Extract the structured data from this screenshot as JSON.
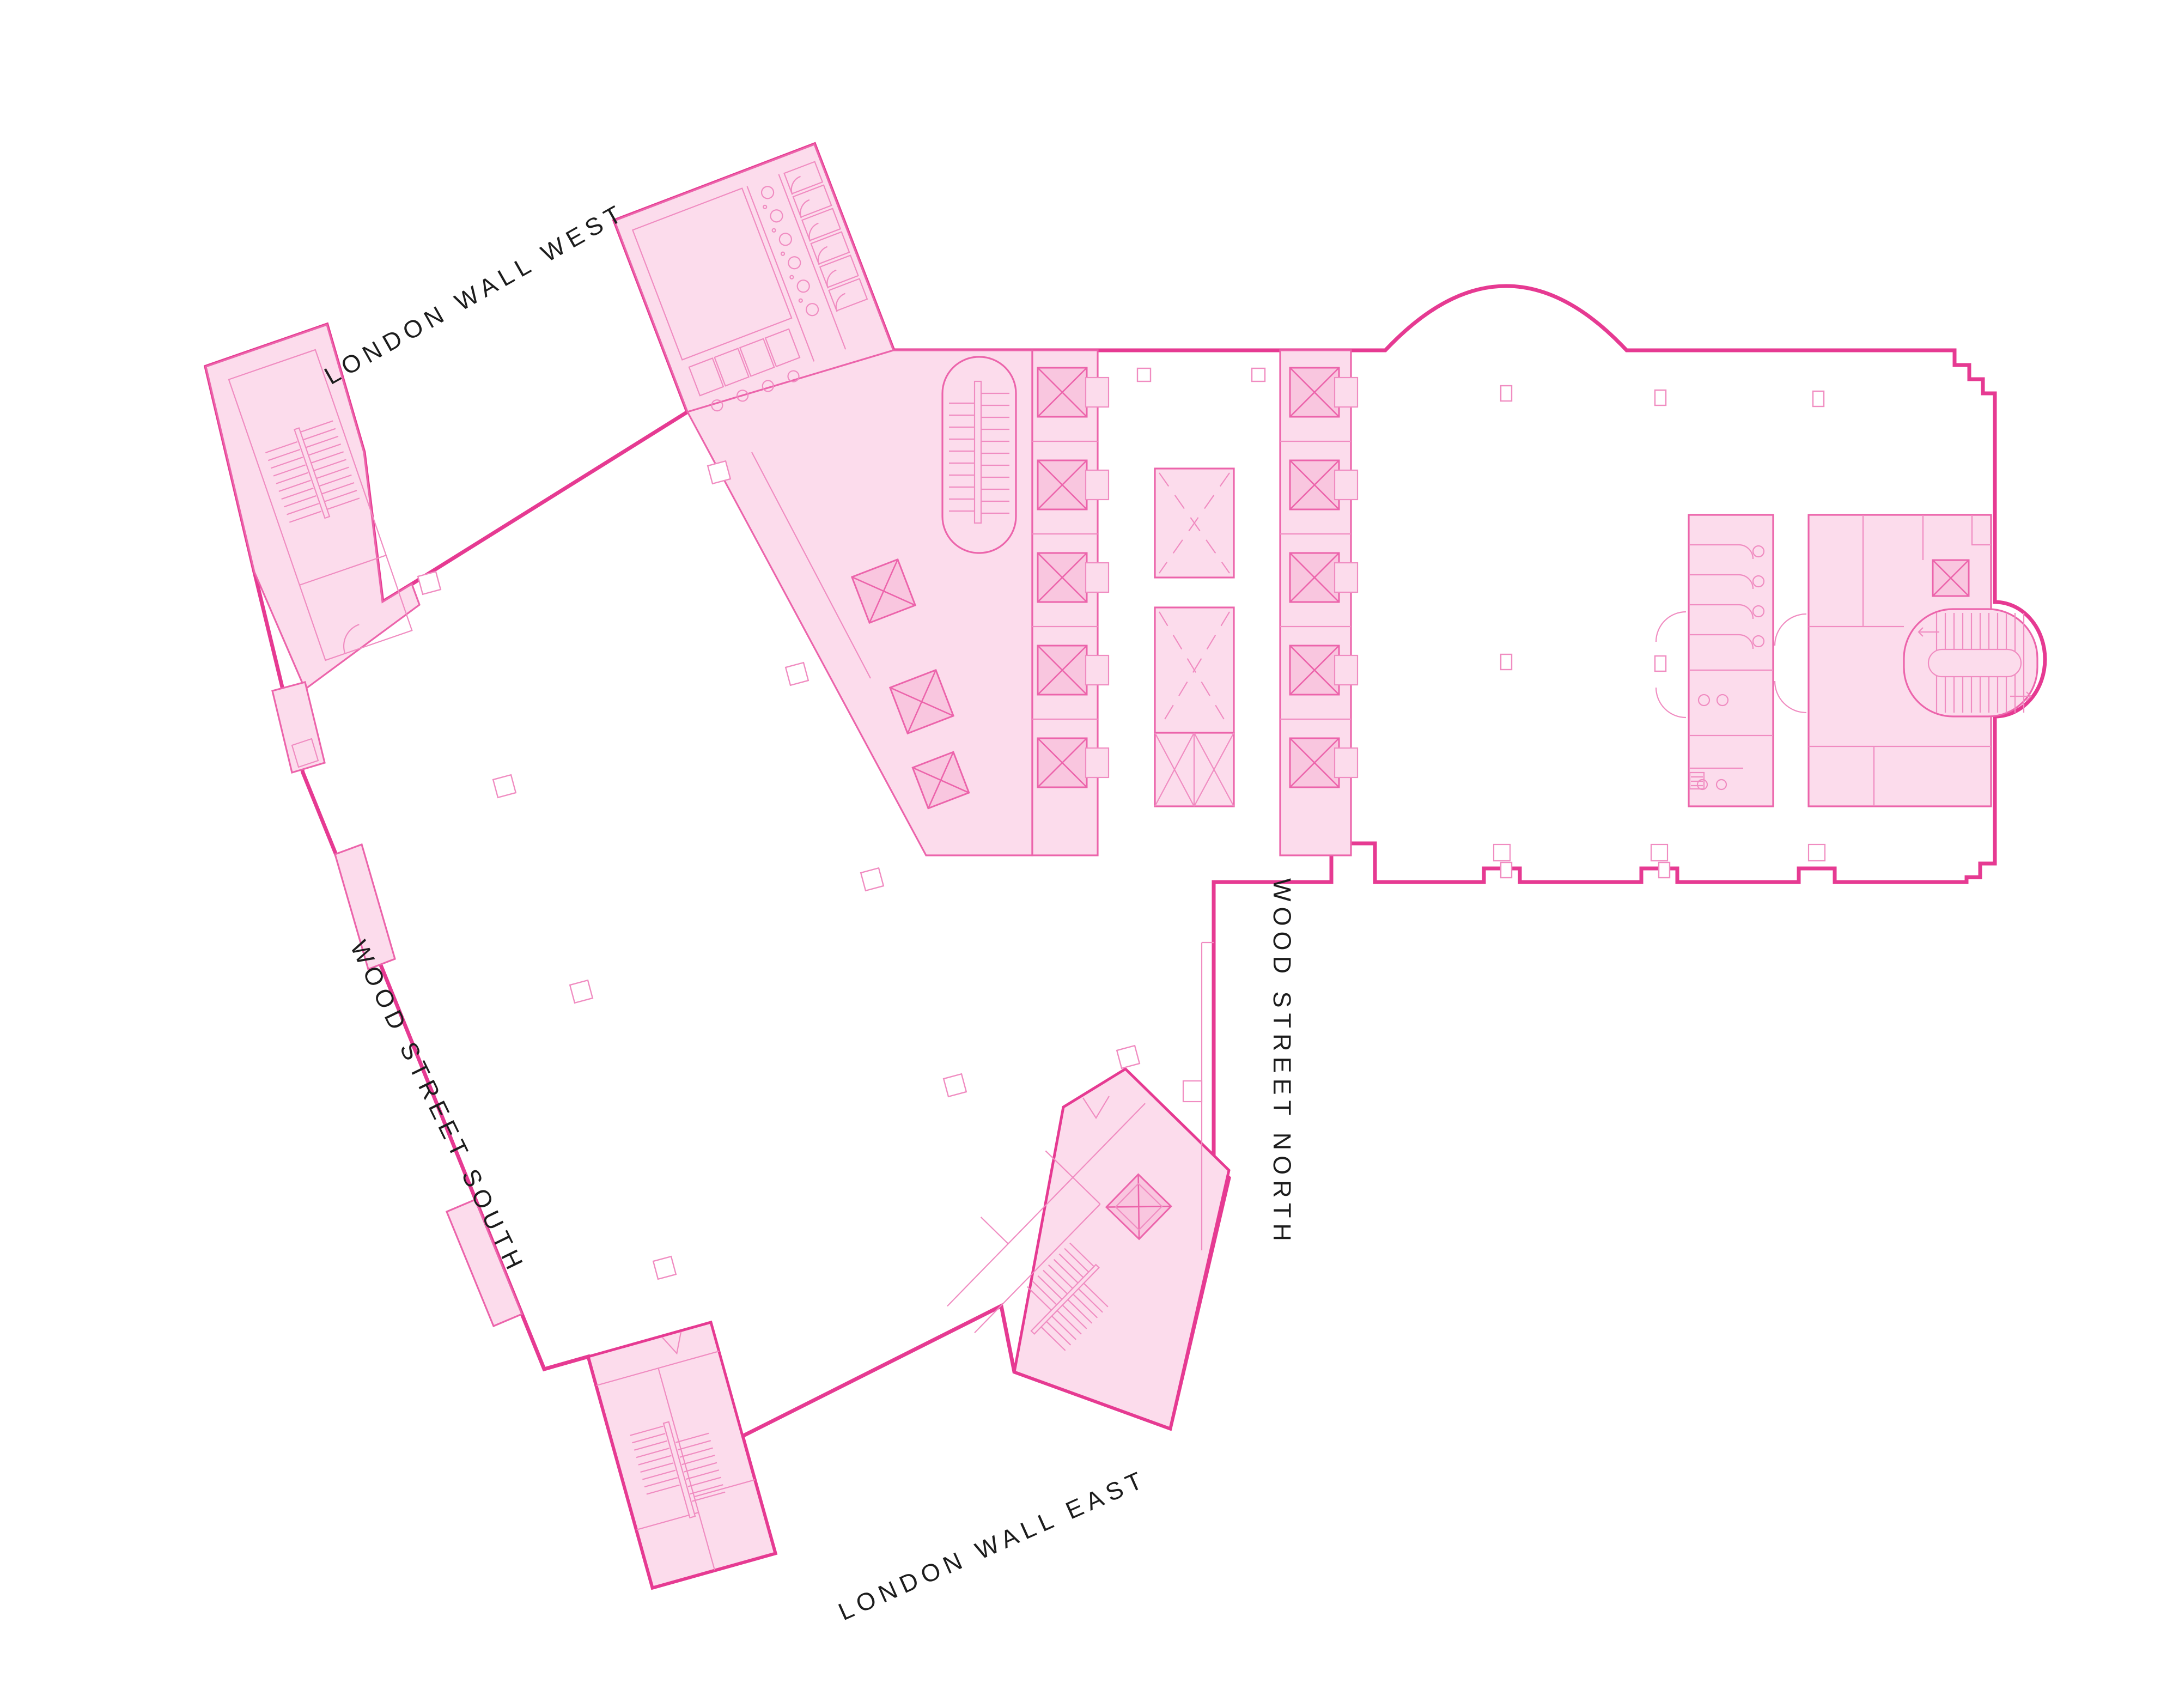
{
  "page": {
    "background": "#ffffff",
    "content_type": "building-floor-plan"
  },
  "plan": {
    "streets": [
      {
        "id": "london-wall-west",
        "label": "LONDON WALL WEST"
      },
      {
        "id": "wood-street-south",
        "label": "WOOD STREET SOUTH"
      },
      {
        "id": "wood-street-north",
        "label": "WOOD STREET NORTH"
      },
      {
        "id": "london-wall-east",
        "label": "LONDON WALL EAST"
      }
    ],
    "icons": [
      {
        "name": "elevator-icon",
        "glyph": "crossed-square"
      },
      {
        "name": "machine-elevator-icon",
        "glyph": "dashed-crossed-rectangle"
      },
      {
        "name": "stair-icon",
        "glyph": "parallel-tread-lines"
      },
      {
        "name": "column-icon",
        "glyph": "small-square-outline"
      },
      {
        "name": "door-icon",
        "glyph": "quarter-circle-arc"
      },
      {
        "name": "wc-fixture-icon",
        "glyph": "small-circle"
      }
    ],
    "features": {
      "elevator_shafts_left_bank": 5,
      "elevator_shafts_right_bank": 5,
      "central_machine_shafts": 3,
      "stair_cores": 5,
      "restroom_cores": 2
    }
  },
  "colors": {
    "outline-strong": "#e63a92",
    "outline-medium": "#ec64ab",
    "outline-thin": "#f08cc1",
    "fill-pink": "#fcdcec",
    "fill-pink-dark": "#f9c6df",
    "label": "#1c1c1c",
    "page-bg": "#ffffff"
  }
}
